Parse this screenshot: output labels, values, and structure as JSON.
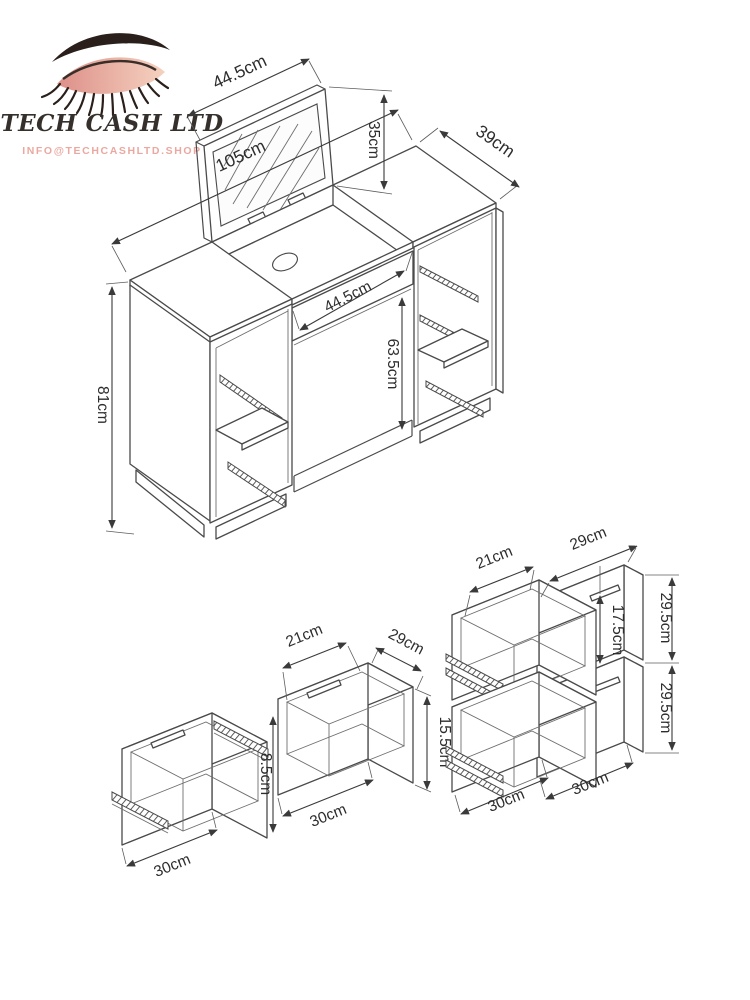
{
  "logo": {
    "brand": "TECH CASH LTD",
    "email": "INFO@TECHCASHLTD.SHOP"
  },
  "colors": {
    "line": "#4a4a4a",
    "dimension_text": "#2d2d2d",
    "brand_text": "#35302c",
    "accent_pink": "#eba8a0",
    "eyelid_pink": "#dd8f88",
    "eyelid_light": "#f5d2c0",
    "lash_dark": "#2a1f1a"
  },
  "views": {
    "main": {
      "title": "dressing table with flip-up mirror",
      "dims": {
        "width": "105cm",
        "mirror_width": "44.5cm",
        "mirror_height": "35cm",
        "depth": "39cm",
        "height": "81cm",
        "middle_drawer_width": "44.5cm",
        "knee_space_height": "63.5cm"
      }
    },
    "small_drawers": {
      "title": "shallow drawers detail",
      "dims": {
        "inner_width": "21cm",
        "depth": "29cm",
        "inner_height": "8.5cm",
        "bottom_left": "30cm",
        "bottom_right": "30cm",
        "outer_height": "15.5cm"
      }
    },
    "large_drawers": {
      "title": "deep drawers detail",
      "dims": {
        "inner_width": "21cm",
        "depth": "29cm",
        "inner_height": "17.5cm",
        "upper_height": "29.5cm",
        "lower_height": "29.5cm",
        "bottom_left": "30cm",
        "bottom_right": "30cm"
      }
    }
  }
}
